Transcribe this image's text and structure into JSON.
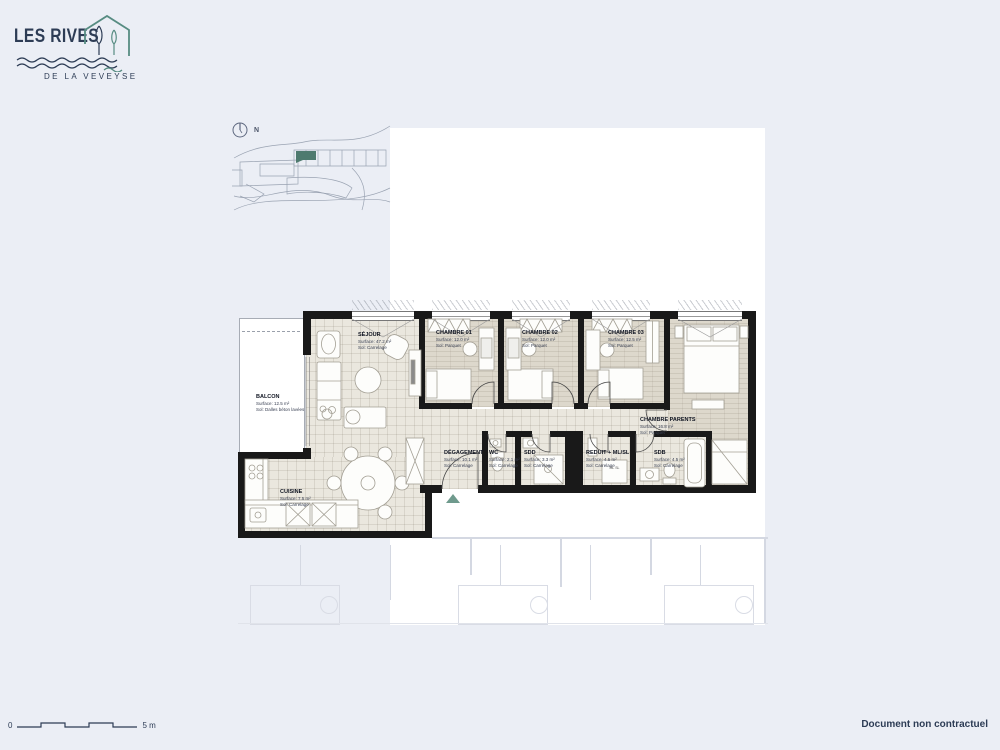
{
  "brand": {
    "title": "LES RIVES",
    "subtitle": "DE LA VEVEYSE",
    "colors": {
      "navy": "#2d3c55",
      "teal": "#578c82",
      "highlight_unit": "#4e7a6f",
      "wall": "#191919"
    }
  },
  "site_plan": {
    "north_label": "N"
  },
  "plan": {
    "rooms": [
      {
        "name": "BALCON",
        "surface": "Surface: 12.5 m²",
        "sol": "Sol: Dalles béton lavées"
      },
      {
        "name": "SÉJOUR",
        "surface": "Surface: 47.2 m²",
        "sol": "Sol: Carrelage"
      },
      {
        "name": "CHAMBRE 01",
        "surface": "Surface: 12.0 m²",
        "sol": "Sol: Parquet"
      },
      {
        "name": "CHAMBRE 02",
        "surface": "Surface: 12.0 m²",
        "sol": "Sol: Parquet"
      },
      {
        "name": "CHAMBRE 03",
        "surface": "Surface: 12.5 m²",
        "sol": "Sol: Parquet"
      },
      {
        "name": "CHAMBRE PARENTS",
        "surface": "Surface: 16.8 m²",
        "sol": "Sol: Parquet"
      },
      {
        "name": "DÉGAGEMENT",
        "surface": "Surface: 10.1 m²",
        "sol": "Sol: Carrelage"
      },
      {
        "name": "WC",
        "surface": "Surface: 2.1 m²",
        "sol": "Sol: Carrelage"
      },
      {
        "name": "SDD",
        "surface": "Surface: 3.3 m²",
        "sol": "Sol: Carrelage"
      },
      {
        "name": "REDUIT + ML/SL",
        "surface": "Surface: 4.5 m²",
        "sol": "Sol: Carrelage"
      },
      {
        "name": "SDB",
        "surface": "Surface: 4.5 m²",
        "sol": "Sol: Carrelage"
      },
      {
        "name": "CUISINE",
        "surface": "Surface: 7.5 m²",
        "sol": "Sol: Carrelage"
      }
    ],
    "appliance_label": "ML SL"
  },
  "footer": {
    "scale_start": "0",
    "scale_end": "5 m",
    "disclaimer": "Document non contractuel"
  }
}
